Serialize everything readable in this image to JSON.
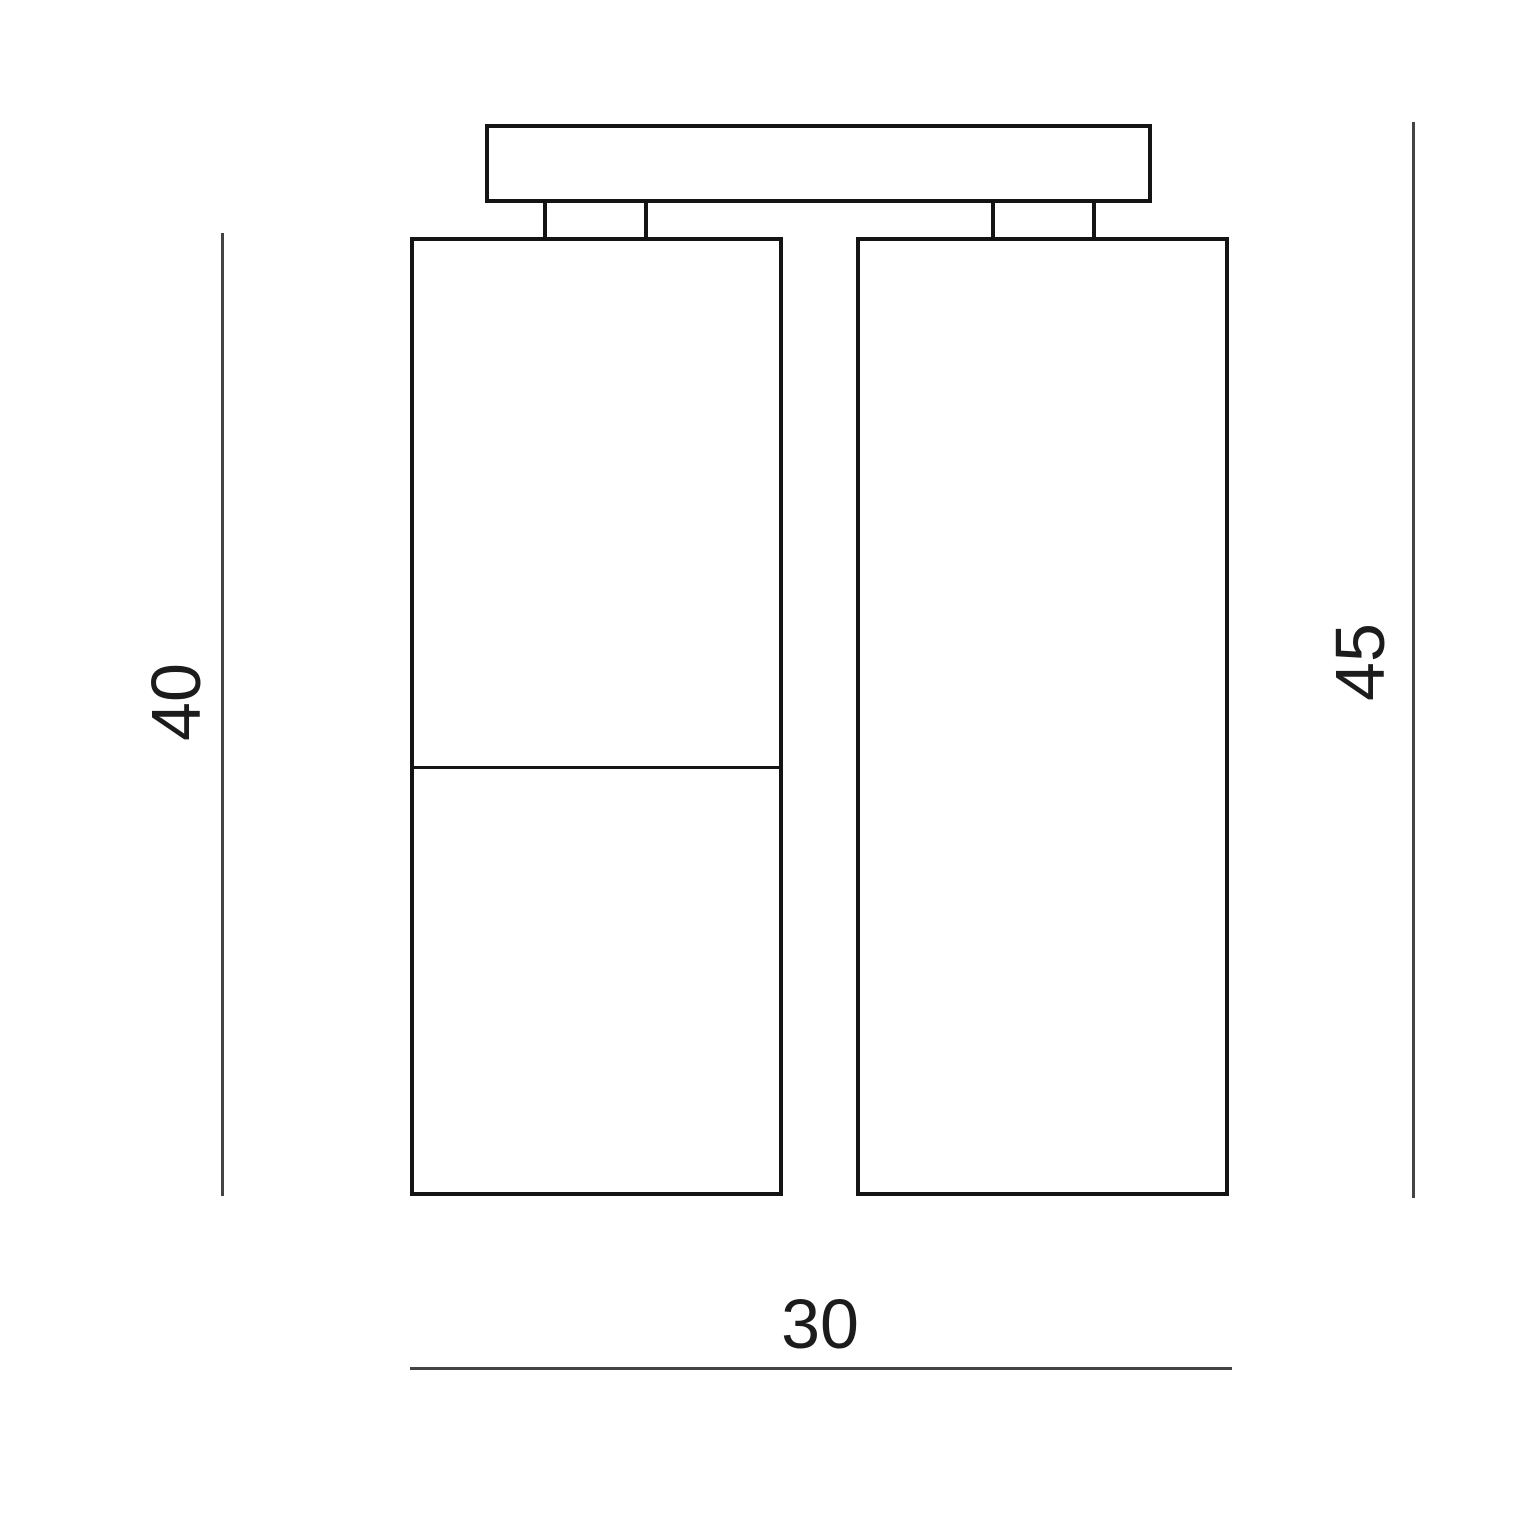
{
  "diagram": {
    "type": "technical-dimension-drawing",
    "dimensions": {
      "left_height": "40",
      "right_height": "45",
      "bottom_width": "30"
    }
  },
  "colors": {
    "background": "#ffffff",
    "outline": "#141414",
    "dimension-line": "#444444",
    "dimension-text": "#1c1c1c"
  }
}
